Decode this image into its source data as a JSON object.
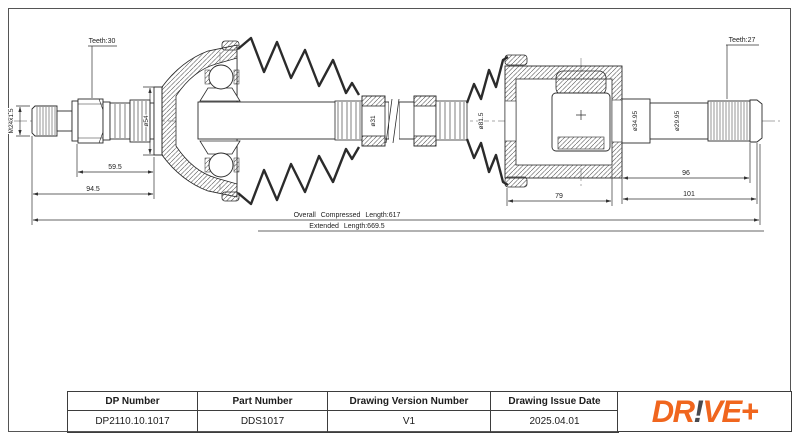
{
  "drawing": {
    "annotations": {
      "teeth_outer": "Teeth:30",
      "teeth_inner": "Teeth:27",
      "thread_spec": "M24x1.5",
      "dia_stem": "ø54",
      "dia_shaft": "ø31",
      "dia_boot": "ø81.5",
      "dia_joint": "ø34.95",
      "dia_stub": "ø29.95"
    },
    "dimensions": {
      "spline_length": "59.5",
      "outer_stub_length": "94.5",
      "inner_joint_length": "79",
      "stub_length": "96",
      "stub_overall": "101",
      "compressed": "Overall Compressed Length:617",
      "extended": "Extended Length:669.5"
    }
  },
  "title_block": {
    "headers": [
      "DP Number",
      "Part Number",
      "Drawing Version Number",
      "Drawing Issue Date"
    ],
    "values": [
      "DP2110.10.1017",
      "DDS1017",
      "V1",
      "2025.04.01"
    ]
  },
  "logo": {
    "dr": "DR",
    "bang": "!",
    "ve": "VE+",
    "orange": "#F0661E",
    "dark": "#4A4A4E"
  }
}
